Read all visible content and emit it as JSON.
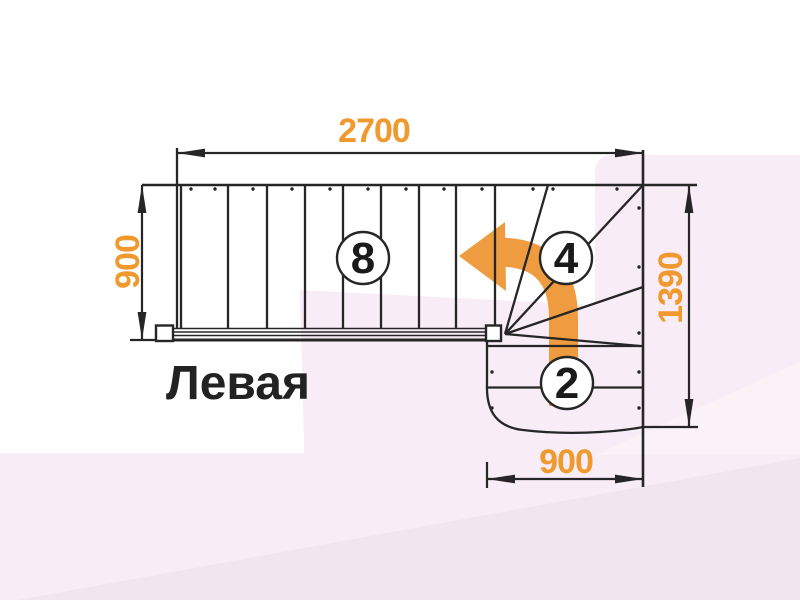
{
  "title": {
    "text": "Левая"
  },
  "dimensions": {
    "top": {
      "value": "2700"
    },
    "left": {
      "value": "900"
    },
    "right": {
      "value": "1390"
    },
    "bottom": {
      "value": "900"
    }
  },
  "steps": {
    "main_flight": {
      "count": "8"
    },
    "winder": {
      "count": "4"
    },
    "lower_flight": {
      "count": "2"
    }
  },
  "colors": {
    "dimension_text": "#F0992E",
    "arrow_fill": "#EE9C3F",
    "line": "#262626",
    "bg_pink": "#F8ECF6",
    "bg_lavender": "#F1E5EF",
    "bg_pink_light": "#FBF2F8"
  }
}
